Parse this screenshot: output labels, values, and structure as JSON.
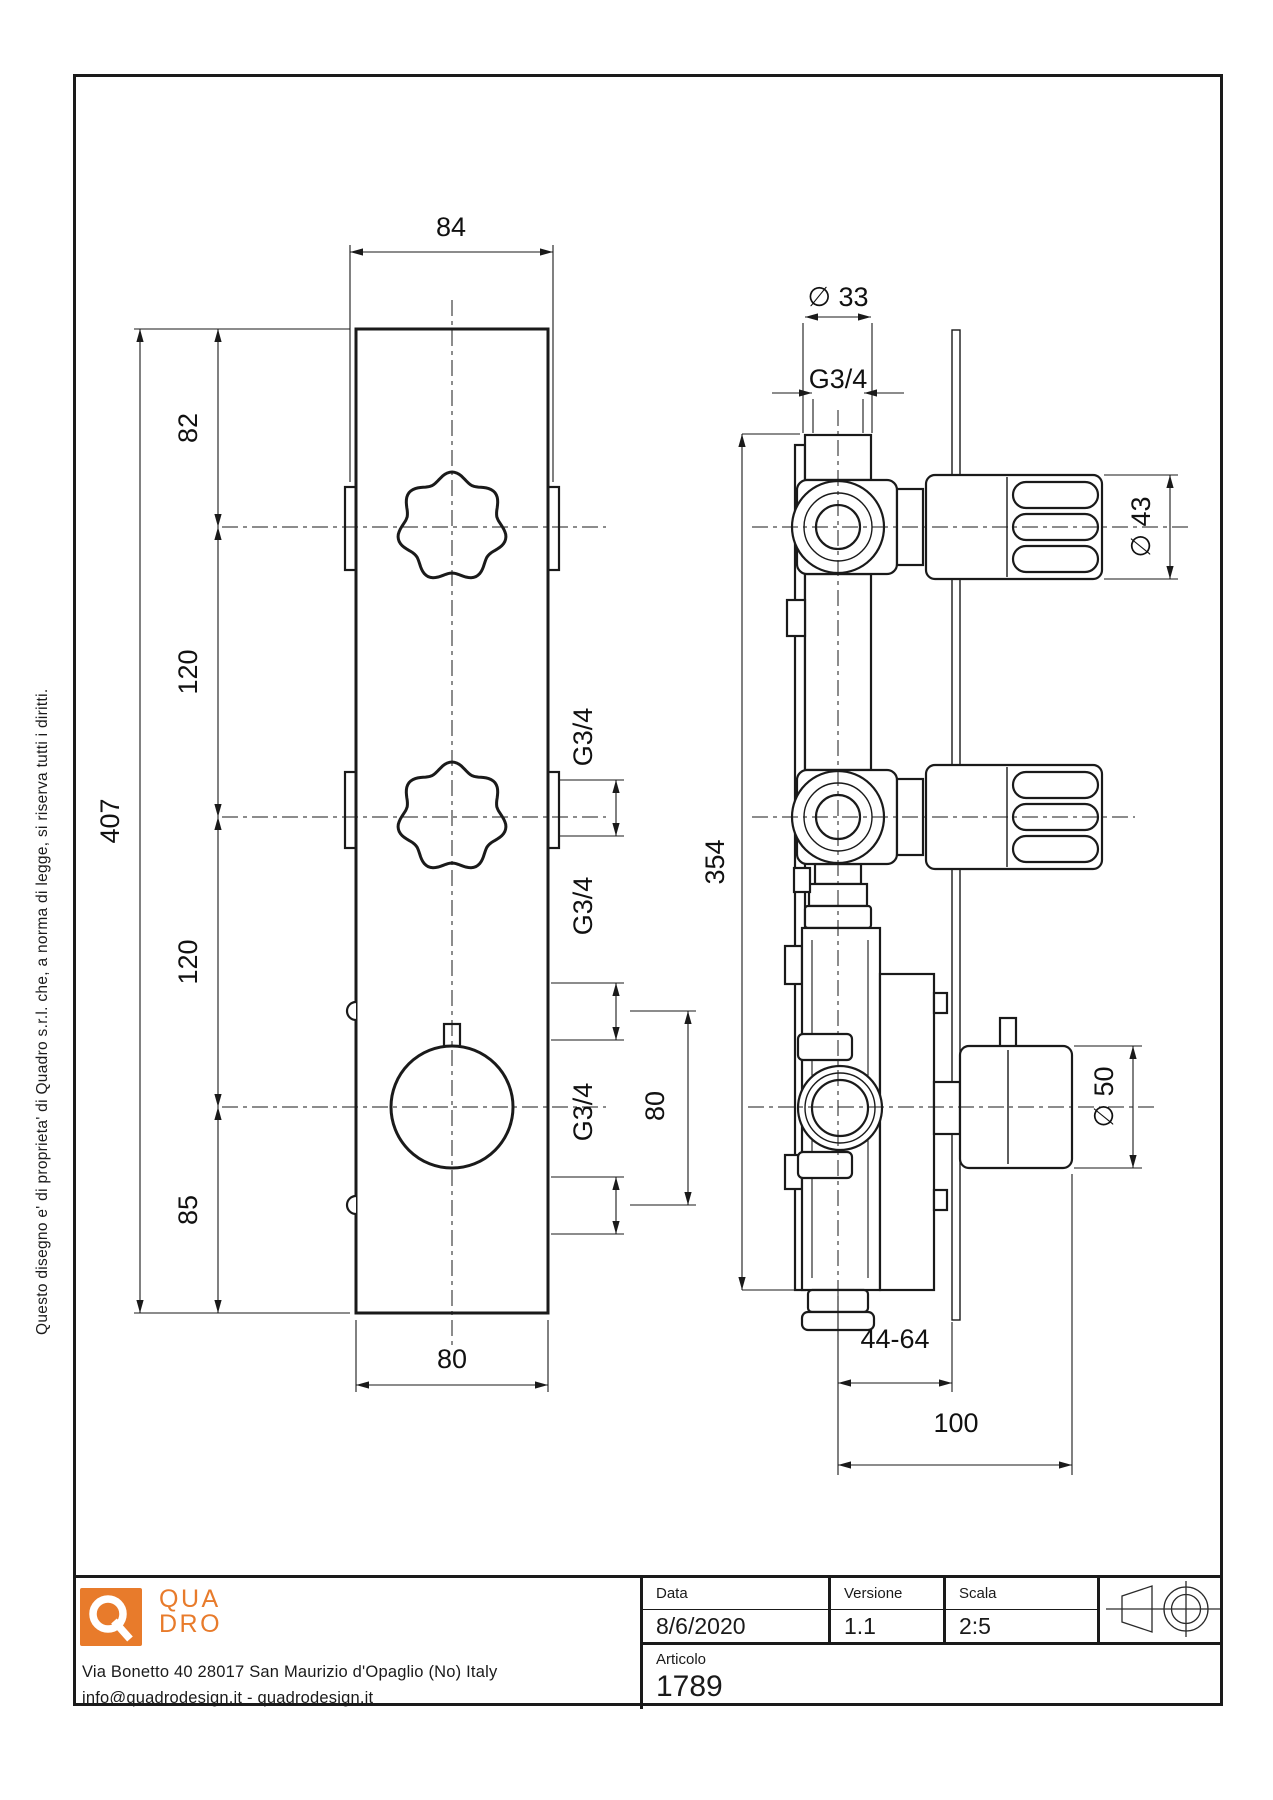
{
  "colors": {
    "line": "#1a1a1a",
    "brand_orange": "#E87B2B",
    "background": "#ffffff"
  },
  "copyright": "Questo disegno e' di proprieta' di Quadro s.r.l. che, a norma di legge, si riserva tutti i diritti.",
  "logo": {
    "line1": "QUA",
    "line2": "DRO"
  },
  "company": {
    "address": "Via Bonetto 40  28017 San Maurizio d'Opaglio (No) Italy",
    "contacts": "info@quadrodesign.it  -  quadrodesign.it"
  },
  "title_block": {
    "data_label": "Data",
    "data_value": "8/6/2020",
    "versione_label": "Versione",
    "versione_value": "1.1",
    "scala_label": "Scala",
    "scala_value": "2:5",
    "articolo_label": "Articolo",
    "articolo_value": "1789"
  },
  "dimensions": [
    {
      "text": "84",
      "x": 451,
      "y": 236,
      "rot": 0
    },
    {
      "text": "82",
      "x": 197,
      "y": 428,
      "rot": -90
    },
    {
      "text": "120",
      "x": 197,
      "y": 672,
      "rot": -90
    },
    {
      "text": "120",
      "x": 197,
      "y": 962,
      "rot": -90
    },
    {
      "text": "85",
      "x": 197,
      "y": 1210,
      "rot": -90
    },
    {
      "text": "407",
      "x": 119,
      "y": 821,
      "rot": -90
    },
    {
      "text": "80",
      "x": 452,
      "y": 1368,
      "rot": 0
    },
    {
      "text": "G3/4",
      "x": 592,
      "y": 737,
      "rot": -90
    },
    {
      "text": "G3/4",
      "x": 592,
      "y": 906,
      "rot": -90
    },
    {
      "text": "G3/4",
      "x": 592,
      "y": 1112,
      "rot": -90
    },
    {
      "text": "80",
      "x": 664,
      "y": 1106,
      "rot": -90
    },
    {
      "text": "∅ 33",
      "x": 838,
      "y": 306,
      "rot": 0
    },
    {
      "text": "G3/4",
      "x": 838,
      "y": 388,
      "rot": 0
    },
    {
      "text": "354",
      "x": 724,
      "y": 862,
      "rot": -90
    },
    {
      "text": "∅ 43",
      "x": 1150,
      "y": 527,
      "rot": -90
    },
    {
      "text": "∅ 50",
      "x": 1113,
      "y": 1097,
      "rot": -90
    },
    {
      "text": "44-64",
      "x": 895,
      "y": 1348,
      "rot": 0
    },
    {
      "text": "100",
      "x": 956,
      "y": 1432,
      "rot": 0
    }
  ]
}
